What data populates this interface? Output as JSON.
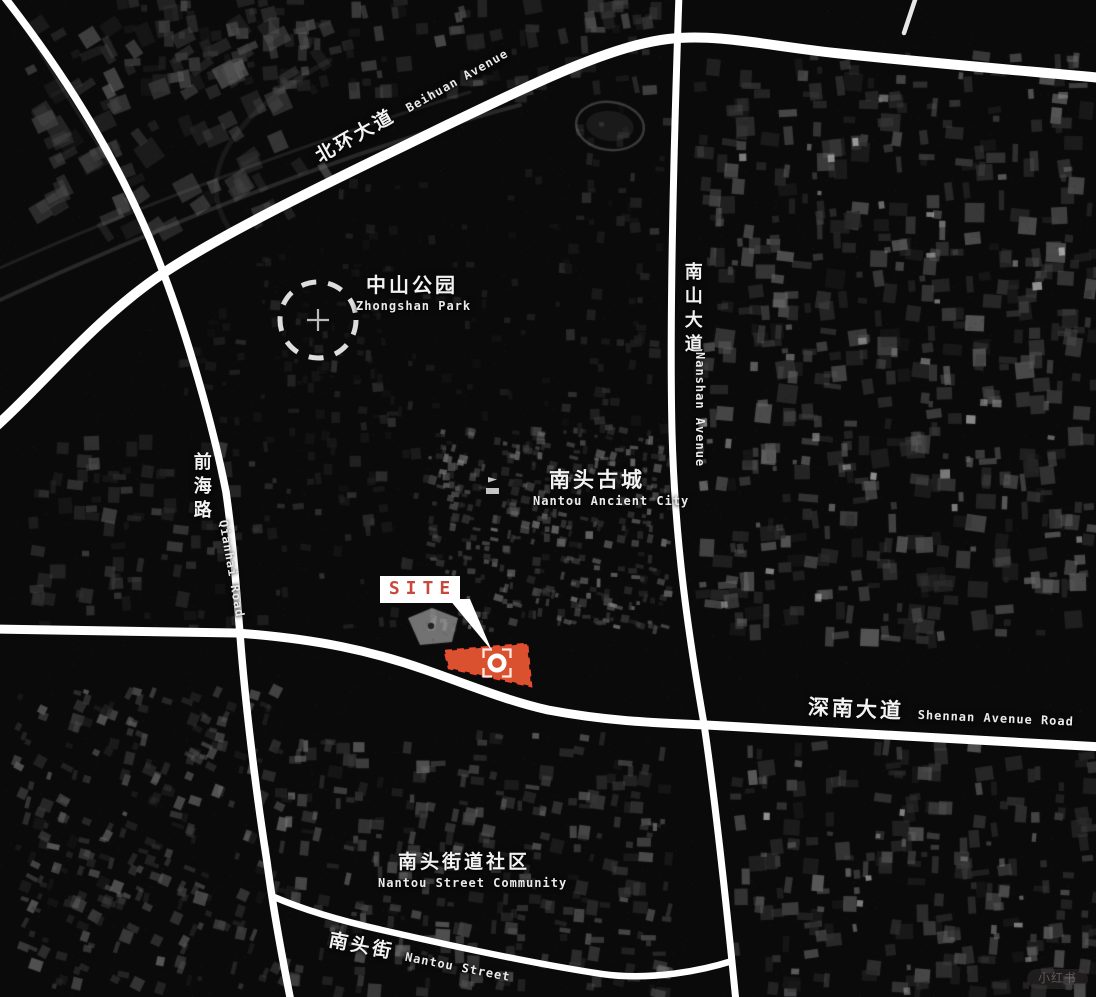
{
  "map": {
    "title": "Nantou site location map",
    "colors": {
      "background": "#0a0a0b",
      "road": "#ffffff",
      "label": "#f2f2f2",
      "site_fill": "#d9512e",
      "site_border": "#ea4b2f",
      "site_label_text": "#c8493b"
    },
    "labels": {
      "beihuan": {
        "zh": "北环大道",
        "en": "Beihuan Avenue"
      },
      "nanshan": {
        "zh": "南山大道",
        "en": "Nanshan Avenue"
      },
      "qianhai": {
        "zh": "前海路",
        "en": "Qianhai Road"
      },
      "zhongshan": {
        "zh": "中山公园",
        "en": "Zhongshan Park"
      },
      "nantou_city": {
        "zh": "南头古城",
        "en": "Nantou Ancient City"
      },
      "shennan": {
        "zh": "深南大道",
        "en": "Shennan Avenue Road"
      },
      "community": {
        "zh": "南头街道社区",
        "en": "Nantou Street Community"
      },
      "nantou_street": {
        "zh": "南头街",
        "en": "Nantou Street"
      }
    },
    "site": {
      "label": "SITE"
    },
    "watermark": "小红书"
  }
}
